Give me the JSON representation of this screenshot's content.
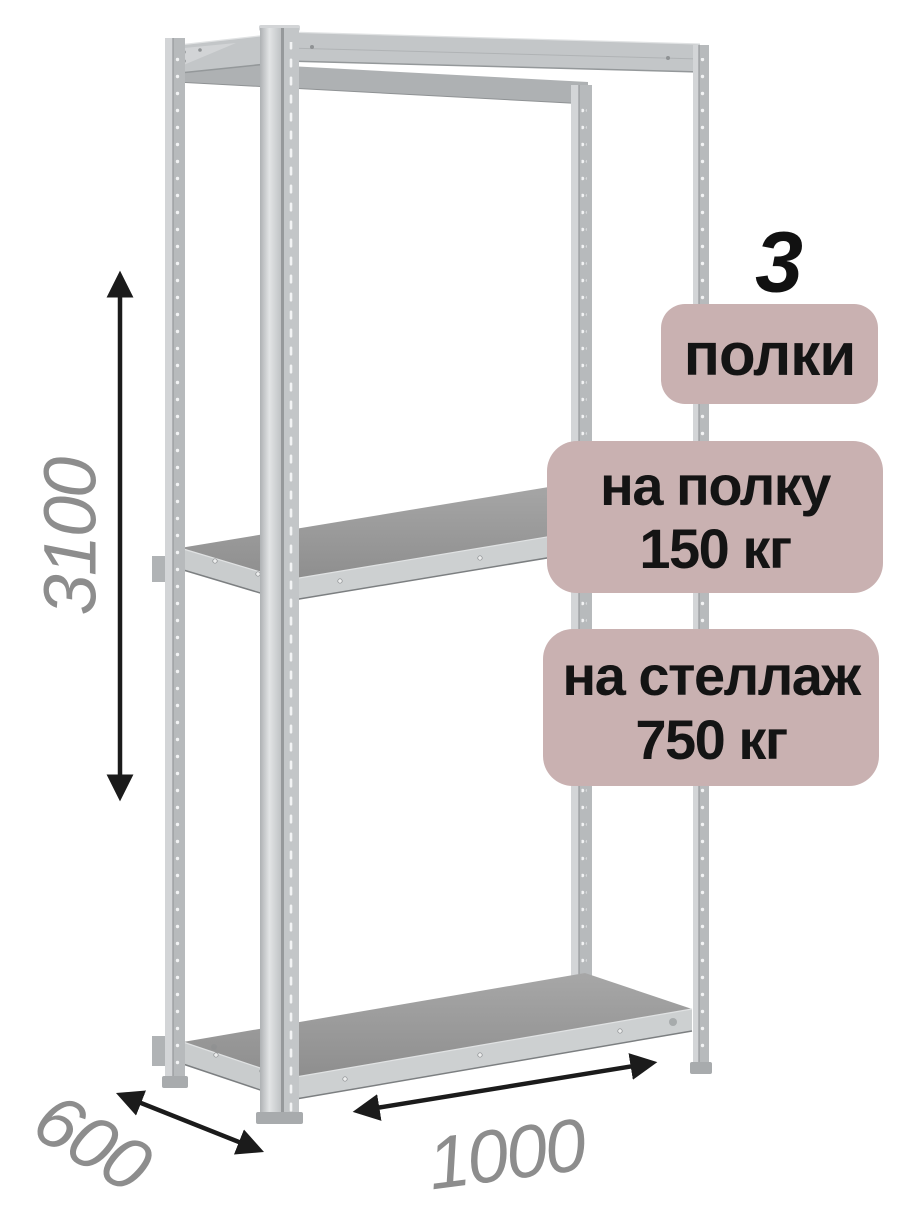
{
  "annotations": {
    "shelf_count": {
      "value": "3",
      "label": "полки"
    },
    "shelf_load": {
      "line1": "на полку",
      "line2": "150 кг"
    },
    "rack_load": {
      "line1": "на стеллаж",
      "line2": "750 кг"
    }
  },
  "dimensions": {
    "height_mm": "3100",
    "depth_mm": "600",
    "width_mm": "1000"
  },
  "colors": {
    "background": "#ffffff",
    "badge_bg": "#c9b1b1",
    "badge_text": "#141414",
    "count_text": "#111111",
    "dimension_text": "#8d8d8d",
    "arrow": "#1b1b1b",
    "metal_light": "#d3d5d7",
    "metal_mid": "#c3c6c8",
    "metal_face": "#b7babc",
    "metal_dark": "#96999b",
    "shelf_top_light": "#a7a7a7",
    "shelf_top_dark": "#8e8e8e",
    "shelf_band": "#c9cccd",
    "shelf_band_edge": "#7c7f81",
    "perforation": "#f2f3f4"
  }
}
